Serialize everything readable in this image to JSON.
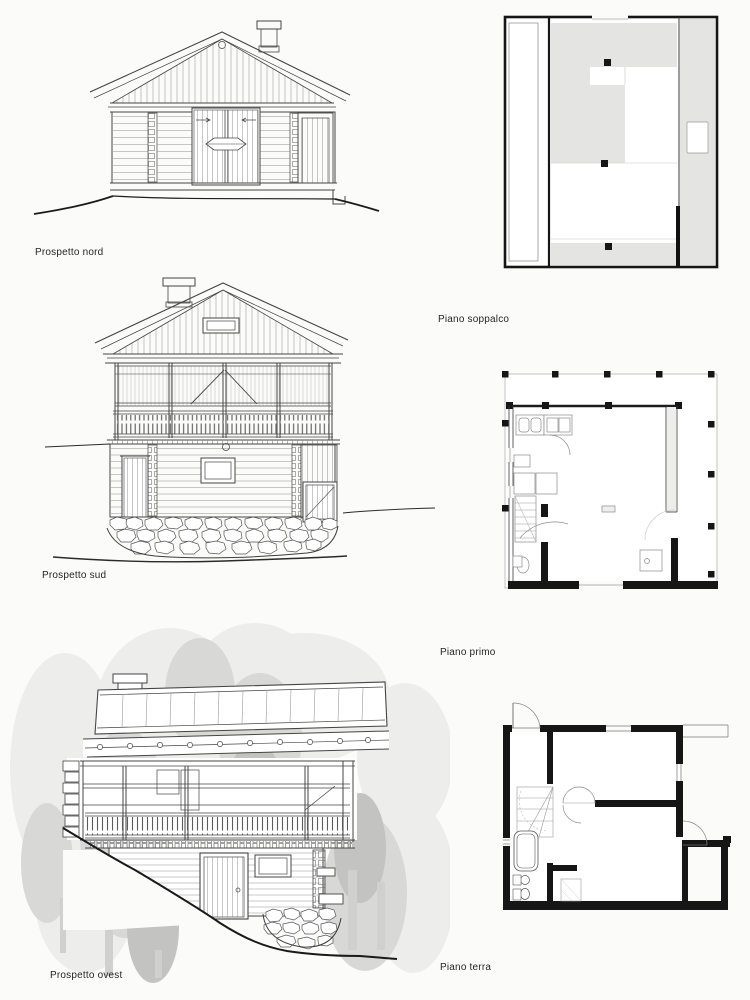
{
  "page": {
    "kind": "scanned architecture book page",
    "background": "#fbfbf9",
    "ink": "#3f3f3f",
    "wall_black": "#161616",
    "plan_gray": "#e4e4e2",
    "tree_light": "#ededeb",
    "tree_mid": "#d8d8d6",
    "tree_dark": "#c3c3c1"
  },
  "figures": {
    "nord": {
      "type": "elevation",
      "label": "Prospetto nord"
    },
    "sud": {
      "type": "elevation",
      "label": "Prospetto sud"
    },
    "ovest": {
      "type": "elevation",
      "label": "Prospetto ovest"
    },
    "soppalco": {
      "type": "floor-plan",
      "label": "Piano soppalco"
    },
    "primo": {
      "type": "floor-plan",
      "label": "Piano primo"
    },
    "terra": {
      "type": "floor-plan",
      "label": "Piano terra"
    }
  }
}
